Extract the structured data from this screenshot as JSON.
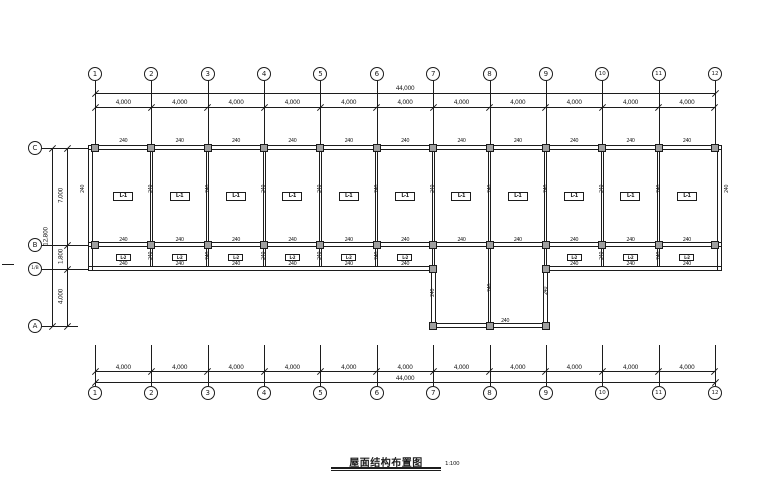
{
  "drawing": {
    "title": "屋面结构布置图",
    "scale": "1:100",
    "colors": {
      "line": "#1c1c1c",
      "column_fill": "#a0a0a0",
      "background": "#ffffff"
    },
    "axes": {
      "columns": [
        "1",
        "2",
        "3",
        "4",
        "5",
        "6",
        "7",
        "8",
        "9",
        "10",
        "11",
        "12"
      ],
      "rows": [
        "C",
        "B",
        "1/B",
        "A"
      ]
    },
    "dimensions": {
      "top_total": "44,000",
      "top_bays": [
        "4,000",
        "4,000",
        "4,000",
        "4,000",
        "4,000",
        "4,000",
        "4,000",
        "4,000",
        "4,000",
        "4,000",
        "4,000"
      ],
      "bottom_total": "44,000",
      "bottom_bays": [
        "4,000",
        "4,000",
        "4,000",
        "4,000",
        "4,000",
        "4,000",
        "4,000",
        "4,000",
        "4,000",
        "4,000",
        "4,000"
      ],
      "left_total": "12,800",
      "left_segments": [
        "7,000",
        "1,800",
        "4,000"
      ]
    },
    "labels": {
      "rooms": [
        "L-1",
        "L-1",
        "L-1",
        "L-1",
        "L-1",
        "L-1",
        "L-1",
        "L-1",
        "L-1",
        "L-1",
        "L-1"
      ],
      "corridor": [
        "L-2",
        "L-2",
        "L-2",
        "L-2",
        "L-2",
        "L-2",
        "L-2",
        "L-2",
        "L-2"
      ],
      "beam": "240"
    }
  }
}
